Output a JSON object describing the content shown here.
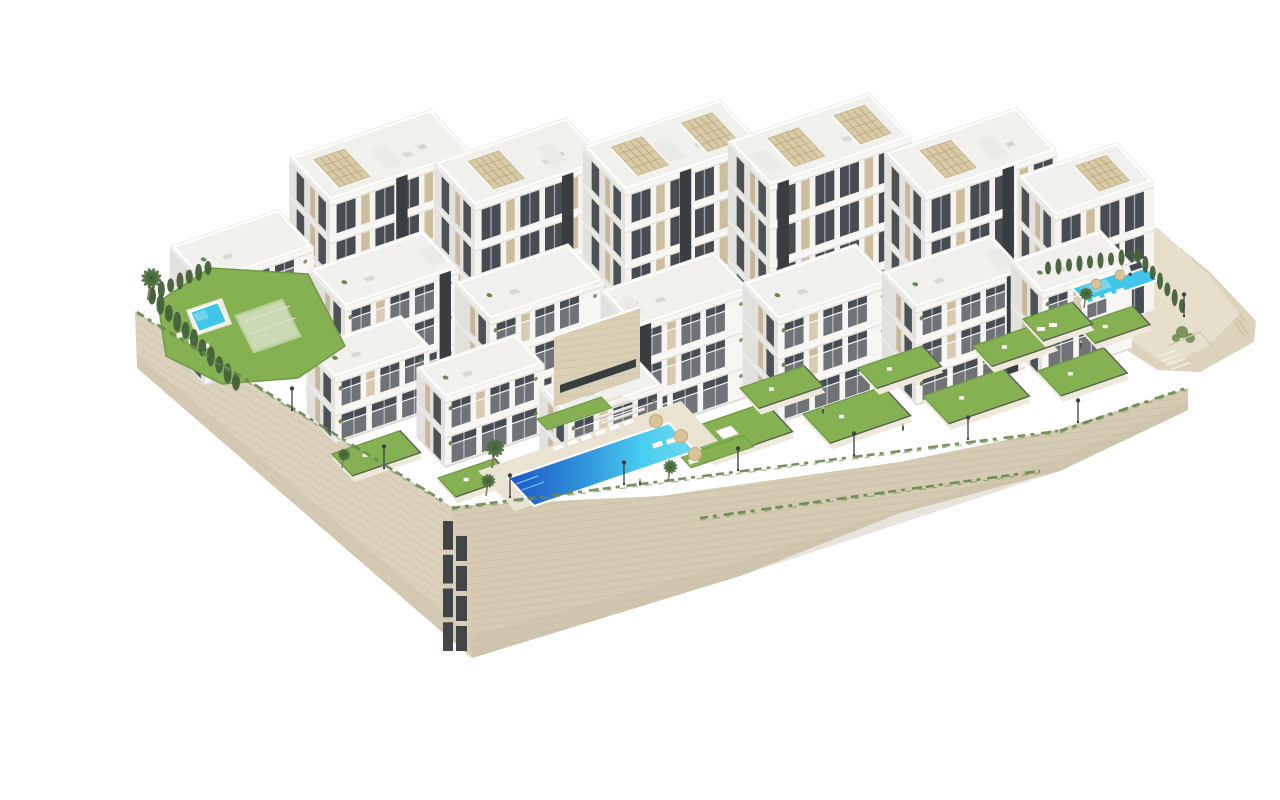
{
  "meta": {
    "title": "Residential complex aerial render",
    "description": "Aerial 3D architectural rendering of a white modern apartment complex on a hillside with stone retaining walls, terraced lawns, three swimming pools, palm trees and rooftop pergolas on a white background"
  },
  "palette": {
    "bg": "#ffffff",
    "buildingFront": "#f5f4f1",
    "buildingSide": "#e3e1dd",
    "roof": "#f1f0ed",
    "slab": "#f8f7f4",
    "slabShadow": "#d7d5d0",
    "windowDark": "#474c52",
    "windowSide": "#3c4145",
    "panelBeige": "#cdbd9d",
    "panelSide": "#c2b394",
    "coreDark": "#3a3d40",
    "pergolaBeige": "#d9c9a4",
    "pergolaLine": "#b3a178",
    "lawnGreen": "#86b152",
    "lawnEdge": "#6d9a44",
    "terracePale": "#efe9db",
    "hedgeGreen": "#44603a",
    "creeperGreen": "#68874e",
    "stoneLeft": "#dbd1bd",
    "stoneRight": "#d6cbb4",
    "stoneLine": "#c3b59c",
    "stoneShade": "#c8bca4",
    "sand": "#e7decb",
    "rock": "#ddd2bc",
    "rockStreak": "#c9bc9f",
    "poolDeep": "#1d55c8",
    "poolAqua": "#49cdf0",
    "poolFlat": "#3fc6e8",
    "deck": "#ebe3d1",
    "fenceDark": "#54585b",
    "lampDark": "#3f4346",
    "carWhite": "#f4f4f2",
    "carGlass": "#454a4f",
    "palmTrunk": "#8a7a62",
    "palmGreen": "#4a6b3c",
    "treeSoft": "#93a489",
    "white": "#ffffff"
  },
  "scene": {
    "axes": {
      "E": [
        0.946,
        -0.324
      ],
      "S": [
        0.68,
        0.73
      ]
    },
    "walls": {
      "left": [
        [
          95,
          295
        ],
        [
          410,
          490
        ],
        [
          432,
          642
        ],
        [
          97,
          352
        ]
      ],
      "right": [
        [
          410,
          490
        ],
        [
          620,
          480
        ],
        [
          860,
          446
        ],
        [
          1020,
          413
        ],
        [
          1148,
          372
        ],
        [
          1148,
          394
        ],
        [
          1020,
          455
        ],
        [
          860,
          497
        ],
        [
          700,
          560
        ],
        [
          432,
          642
        ]
      ]
    },
    "stoneSlots": [
      {
        "x": 403,
        "y": 505,
        "w": 10,
        "h": 135
      },
      {
        "x": 416,
        "y": 520,
        "w": 11,
        "h": 120
      }
    ],
    "creepers": [
      {
        "from": [
          97,
          296
        ],
        "to": [
          408,
          488
        ]
      },
      {
        "from": [
          412,
          492
        ],
        "to": [
          1018,
          415
        ]
      },
      {
        "from": [
          1020,
          415
        ],
        "to": [
          1146,
          372
        ]
      },
      {
        "from": [
          660,
          502
        ],
        "to": [
          1000,
          455
        ]
      }
    ],
    "rock": [
      [
        1110,
        208
      ],
      [
        1170,
        256
      ],
      [
        1216,
        305
      ],
      [
        1214,
        326
      ],
      [
        1160,
        356
      ],
      [
        1118,
        354
      ],
      [
        1080,
        330
      ],
      [
        1040,
        300
      ]
    ],
    "sand": [
      [
        945,
        238
      ],
      [
        1020,
        222
      ],
      [
        1118,
        212
      ],
      [
        1168,
        258
      ],
      [
        1200,
        298
      ],
      [
        1168,
        330
      ],
      [
        1128,
        350
      ],
      [
        1050,
        295
      ],
      [
        985,
        258
      ]
    ],
    "rockStreaks": [
      [
        1128,
        226,
        1180,
        290
      ],
      [
        1140,
        232,
        1196,
        296
      ],
      [
        1152,
        242,
        1205,
        305
      ],
      [
        1164,
        254,
        1208,
        318
      ],
      [
        1120,
        220,
        1160,
        262
      ],
      [
        1176,
        280,
        1206,
        322
      ]
    ],
    "sandContours": [
      [
        960,
        250,
        1040,
        238
      ],
      [
        1000,
        272,
        1090,
        254
      ]
    ],
    "backSlabs": [
      {
        "x": 290,
        "y": 335,
        "w": 150,
        "d": 60,
        "h": 150,
        "core": 70,
        "pergolas": [
          18
        ],
        "floors": 4
      },
      {
        "x": 435,
        "y": 350,
        "w": 140,
        "d": 60,
        "h": 160,
        "core": 92,
        "pergolas": [
          28
        ],
        "floors": 4
      },
      {
        "x": 585,
        "y": 360,
        "w": 145,
        "d": 62,
        "h": 185,
        "core": 58,
        "pergolas": [
          22,
          96
        ],
        "floors": 5
      },
      {
        "x": 730,
        "y": 365,
        "w": 150,
        "d": 62,
        "h": 195,
        "core": 8,
        "pergolas": [
          34,
          104
        ],
        "floors": 5
      },
      {
        "x": 885,
        "y": 350,
        "w": 140,
        "d": 60,
        "h": 170,
        "core": 82,
        "pergolas": [
          30
        ],
        "floors": 4
      },
      {
        "x": 1015,
        "y": 330,
        "w": 105,
        "d": 55,
        "h": 130,
        "core": null,
        "pergolas": [
          54
        ],
        "floors": 3
      }
    ],
    "midBlocks": [
      {
        "x": 165,
        "y": 370,
        "w": 115,
        "d": 52,
        "h": 102,
        "floors": 3,
        "core": null
      },
      {
        "x": 305,
        "y": 396,
        "w": 120,
        "d": 52,
        "h": 105,
        "floors": 3,
        "core": 100
      },
      {
        "x": 450,
        "y": 412,
        "w": 120,
        "d": 52,
        "h": 108,
        "floors": 3,
        "core": null
      },
      {
        "x": 596,
        "y": 420,
        "w": 120,
        "d": 52,
        "h": 108,
        "floors": 3,
        "core": 4
      },
      {
        "x": 738,
        "y": 408,
        "w": 120,
        "d": 52,
        "h": 104,
        "floors": 3,
        "core": null
      },
      {
        "x": 876,
        "y": 390,
        "w": 115,
        "d": 50,
        "h": 98,
        "floors": 3,
        "core": 96
      },
      {
        "x": 1002,
        "y": 364,
        "w": 95,
        "d": 46,
        "h": 86,
        "floors": 2,
        "core": null
      }
    ],
    "frontBlocks": [
      {
        "x": 295,
        "y": 428,
        "w": 100,
        "d": 42,
        "h": 66,
        "floors": 2,
        "core": null
      },
      {
        "x": 405,
        "y": 452,
        "w": 105,
        "d": 42,
        "h": 70,
        "floors": 2,
        "core": null
      },
      {
        "x": 528,
        "y": 470,
        "w": 100,
        "d": 42,
        "h": 68,
        "floors": 2,
        "core": null
      }
    ],
    "entrance": {
      "face": [
        [
          514,
          320
        ],
        [
          600,
          291
        ],
        [
          600,
          362
        ],
        [
          514,
          391
        ]
      ],
      "slot": [
        [
          520,
          369
        ],
        [
          596,
          343
        ],
        [
          596,
          351
        ],
        [
          520,
          377
        ]
      ],
      "stairs": {
        "x": 538,
        "y": 393,
        "n": 6,
        "stepW": 46,
        "dx": 7.6,
        "dy": 4.4
      }
    },
    "leftGarden": {
      "lawn": [
        [
          118,
          286
        ],
        [
          170,
          252
        ],
        [
          268,
          258
        ],
        [
          305,
          330
        ],
        [
          258,
          362
        ],
        [
          182,
          368
        ],
        [
          126,
          340
        ]
      ],
      "poolDeck": [
        [
          146,
          294
        ],
        [
          182,
          282
        ],
        [
          192,
          308
        ],
        [
          156,
          320
        ]
      ],
      "pool": [
        [
          150,
          296
        ],
        [
          178,
          286
        ],
        [
          187,
          306
        ],
        [
          159,
          316
        ]
      ],
      "loungers": [
        [
          136,
          318
        ],
        [
          148,
          324
        ],
        [
          160,
          330
        ]
      ],
      "pergola": [
        [
          196,
          300
        ],
        [
          242,
          284
        ],
        [
          260,
          320
        ],
        [
          214,
          336
        ]
      ],
      "furniture": [
        [
          225,
          318
        ],
        [
          233,
          322
        ],
        [
          218,
          324
        ],
        [
          240,
          314
        ]
      ]
    },
    "lawns": [
      {
        "p": [
          645,
          414
        ],
        "w": 85,
        "d": 40,
        "gazebo": true
      },
      {
        "p": [
          763,
          398
        ],
        "w": 85,
        "d": 40
      },
      {
        "p": [
          883,
          380
        ],
        "w": 85,
        "d": 38
      },
      {
        "p": [
          998,
          355
        ],
        "w": 70,
        "d": 34
      },
      {
        "p": [
          700,
          372
        ],
        "w": 68,
        "d": 28
      },
      {
        "p": [
          818,
          352
        ],
        "w": 68,
        "d": 28
      },
      {
        "p": [
          933,
          330
        ],
        "w": 68,
        "d": 28
      },
      {
        "p": [
          1038,
          309
        ],
        "w": 58,
        "d": 25
      },
      {
        "p": [
          983,
          303
        ],
        "w": 52,
        "d": 30,
        "loungers": true
      },
      {
        "p": [
          292,
          438
        ],
        "w": 72,
        "d": 30
      },
      {
        "p": [
          398,
          462
        ],
        "w": 60,
        "d": 26
      }
    ],
    "bigPool": {
      "deck": [
        [
          438,
          455
        ],
        [
          641,
          385
        ],
        [
          678,
          425
        ],
        [
          475,
          495
        ]
      ],
      "water": [
        [
          468,
          462
        ],
        [
          629,
          407
        ],
        [
          655,
          435
        ],
        [
          494,
          490
        ]
      ],
      "loungers": [
        [
          513,
          431
        ],
        [
          527,
          426
        ],
        [
          541,
          421
        ],
        [
          555,
          416
        ],
        [
          569,
          411
        ],
        [
          583,
          406
        ]
      ],
      "umbrellas": [
        [
          616,
          405
        ],
        [
          641,
          420
        ],
        [
          655,
          438
        ]
      ],
      "extraLoungers": [
        [
          612,
          428
        ],
        [
          626,
          424
        ],
        [
          648,
          444
        ]
      ],
      "lawnStrips": [
        {
          "p": [
            497,
            403
          ],
          "w": 68,
          "d": 15
        },
        {
          "p": [
            641,
            441
          ],
          "w": 66,
          "d": 15
        }
      ]
    },
    "rightPool": {
      "water": [
        [
          1032,
          272
        ],
        [
          1103,
          248
        ],
        [
          1118,
          264
        ],
        [
          1047,
          288
        ]
      ],
      "umbrellas": [
        [
          1056,
          268
        ],
        [
          1080,
          259
        ]
      ],
      "loungers": [
        [
          1040,
          286
        ],
        [
          1052,
          282
        ],
        [
          1064,
          278
        ],
        [
          1076,
          274
        ]
      ]
    },
    "hedges": [
      {
        "from": [
          112,
          280
        ],
        "to": [
          196,
          366
        ],
        "n": 11,
        "rx": 4,
        "ry": 8.5
      },
      {
        "from": [
          112,
          278
        ],
        "to": [
          168,
          252
        ],
        "n": 7,
        "rx": 3.5,
        "ry": 7
      },
      {
        "from": [
          1098,
          240
        ],
        "to": [
          1142,
          290
        ],
        "n": 7,
        "rx": 3,
        "ry": 7
      },
      {
        "from": [
          1008,
          252
        ],
        "to": [
          1092,
          240
        ],
        "n": 9,
        "rx": 3,
        "ry": 6.5
      }
    ],
    "palms": [
      {
        "x": 108,
        "y": 284,
        "s": 1.15
      },
      {
        "x": 452,
        "y": 452,
        "s": 1.05
      },
      {
        "x": 446,
        "y": 480,
        "s": 0.8
      },
      {
        "x": 628,
        "y": 466,
        "s": 0.8
      },
      {
        "x": 1044,
        "y": 292,
        "s": 0.75
      },
      {
        "x": 302,
        "y": 452,
        "s": 0.7
      }
    ],
    "trees": [
      {
        "x": 152,
        "y": 252,
        "r": 13
      },
      {
        "x": 174,
        "y": 243,
        "r": 10
      },
      {
        "x": 190,
        "y": 253,
        "r": 9
      },
      {
        "x": 138,
        "y": 262,
        "r": 8
      }
    ],
    "shrubs": [
      {
        "x": 1142,
        "y": 316,
        "r": 6
      },
      {
        "x": 1150,
        "y": 322,
        "r": 5
      },
      {
        "x": 1136,
        "y": 322,
        "r": 4
      }
    ],
    "lamps": [
      [
        252,
        394
      ],
      [
        344,
        452
      ],
      [
        470,
        481
      ],
      [
        584,
        468
      ],
      [
        698,
        454
      ],
      [
        814,
        439
      ],
      [
        928,
        423
      ],
      [
        1038,
        406
      ],
      [
        1144,
        300
      ]
    ],
    "car": {
      "x": 1082,
      "y": 250,
      "angle": -19,
      "w": 26,
      "h": 10
    },
    "stairsRight": {
      "x": 1116,
      "y": 340,
      "n": 4,
      "stepW": 20,
      "dx": 5,
      "dy": 4
    },
    "people": [
      [
        783,
        397
      ],
      [
        863,
        414
      ],
      [
        1041,
        331
      ],
      [
        600,
        469
      ]
    ]
  }
}
